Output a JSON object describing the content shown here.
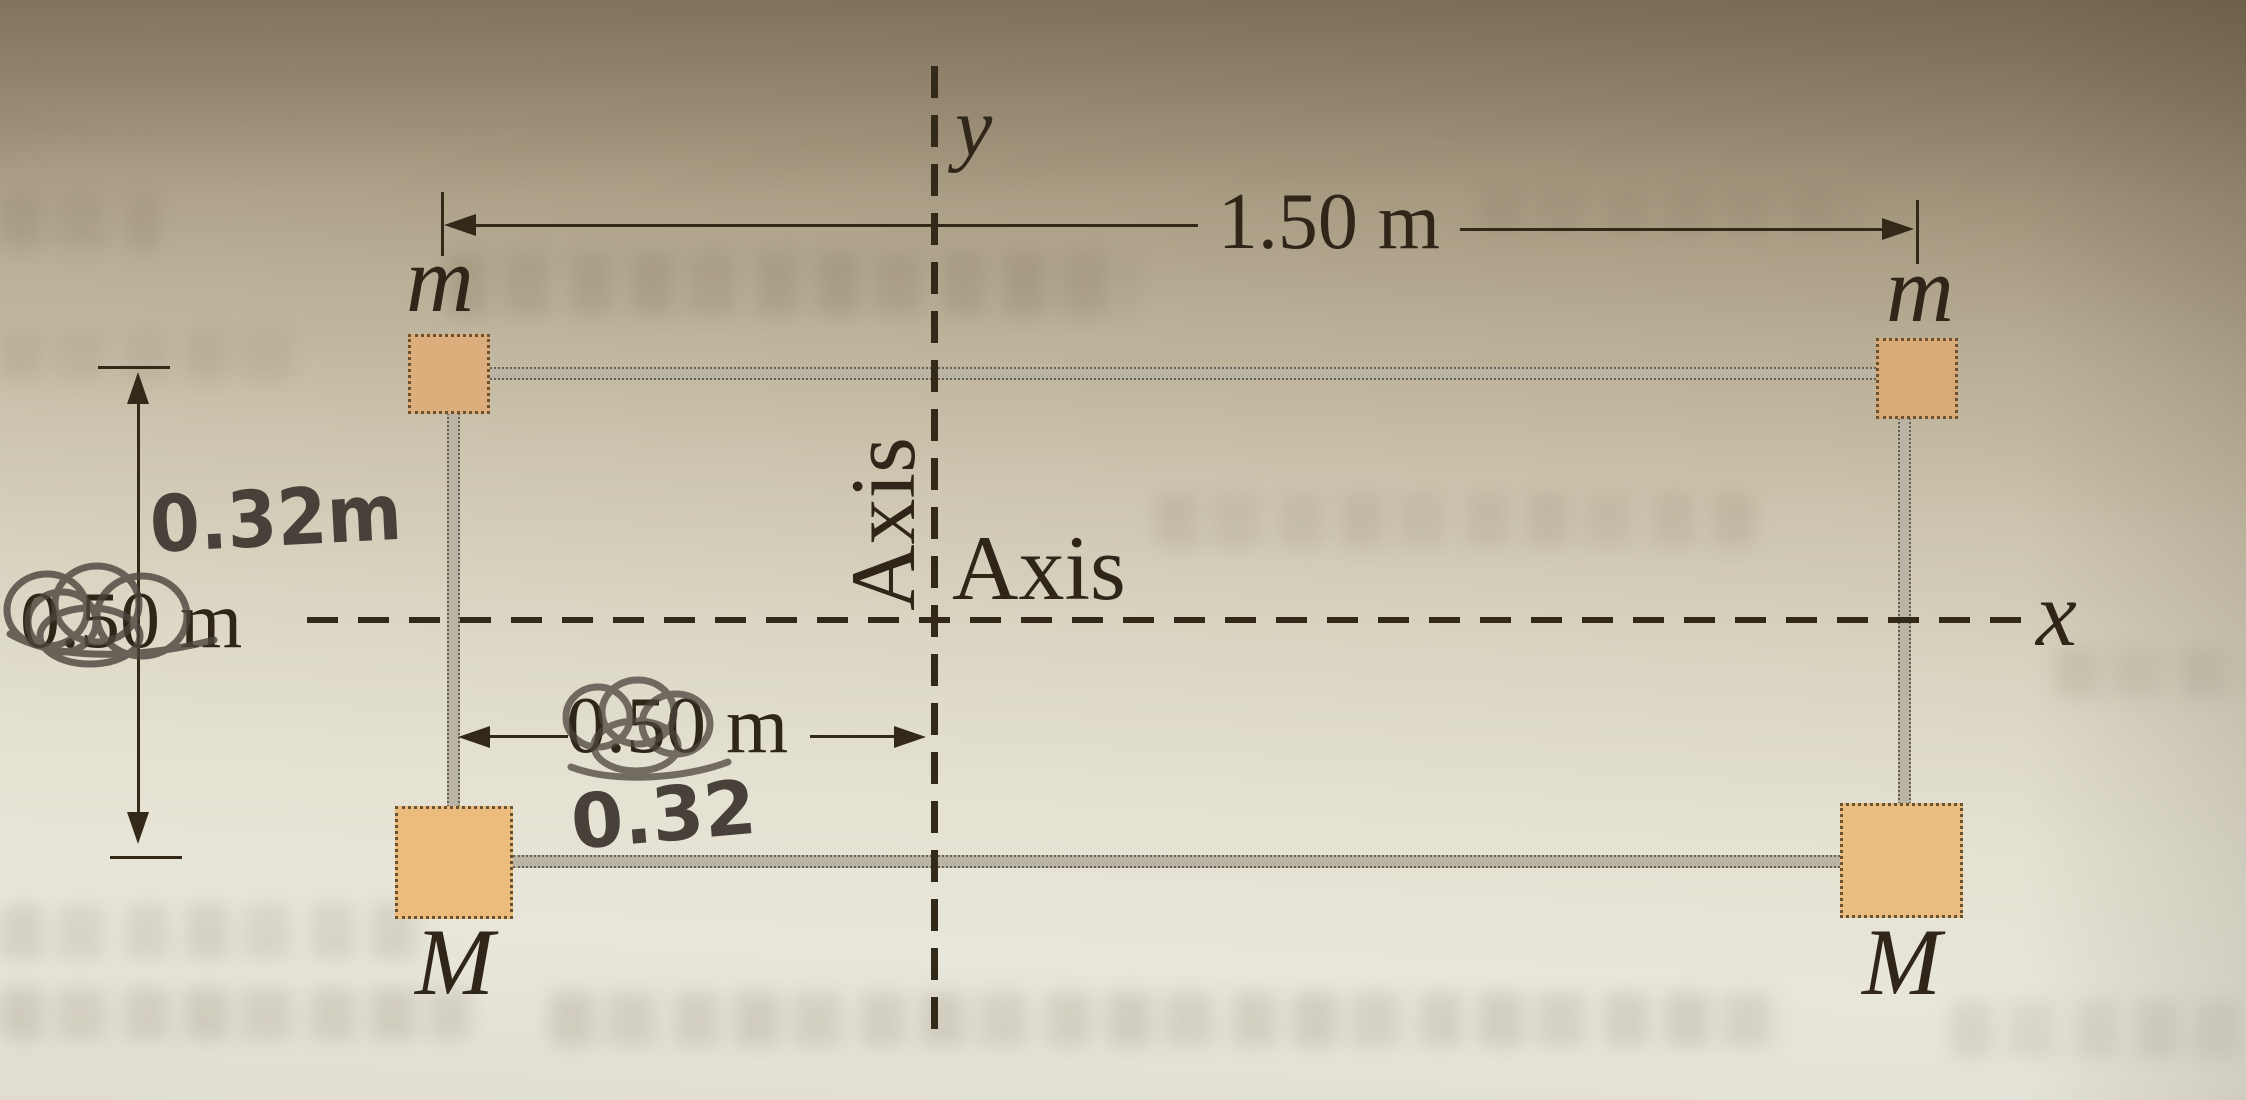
{
  "figure": {
    "axis_y_label": "y",
    "axis_x_label": "x",
    "axis_label_vertical": "Axis",
    "axis_label_horizontal": "Axis",
    "dim_top_width": "1.50 m",
    "dim_left_height_printed": "0.50 m",
    "dim_left_height_handwritten": "0.32m",
    "dim_center_width_printed": "0.50 m",
    "dim_center_width_handwritten": "0.32",
    "mass_top_left": "m",
    "mass_top_right": "m",
    "mass_bottom_left": "M",
    "mass_bottom_right": "M"
  },
  "colors": {
    "ink": "#322918",
    "pencil": "#47413a",
    "small_square_fill": "#dcae7c",
    "large_square_fill": "#ecbc7d",
    "rod_fill": "#b9b4a6",
    "page_top": "#8b7b63",
    "page_bottom": "#e8e6da"
  }
}
